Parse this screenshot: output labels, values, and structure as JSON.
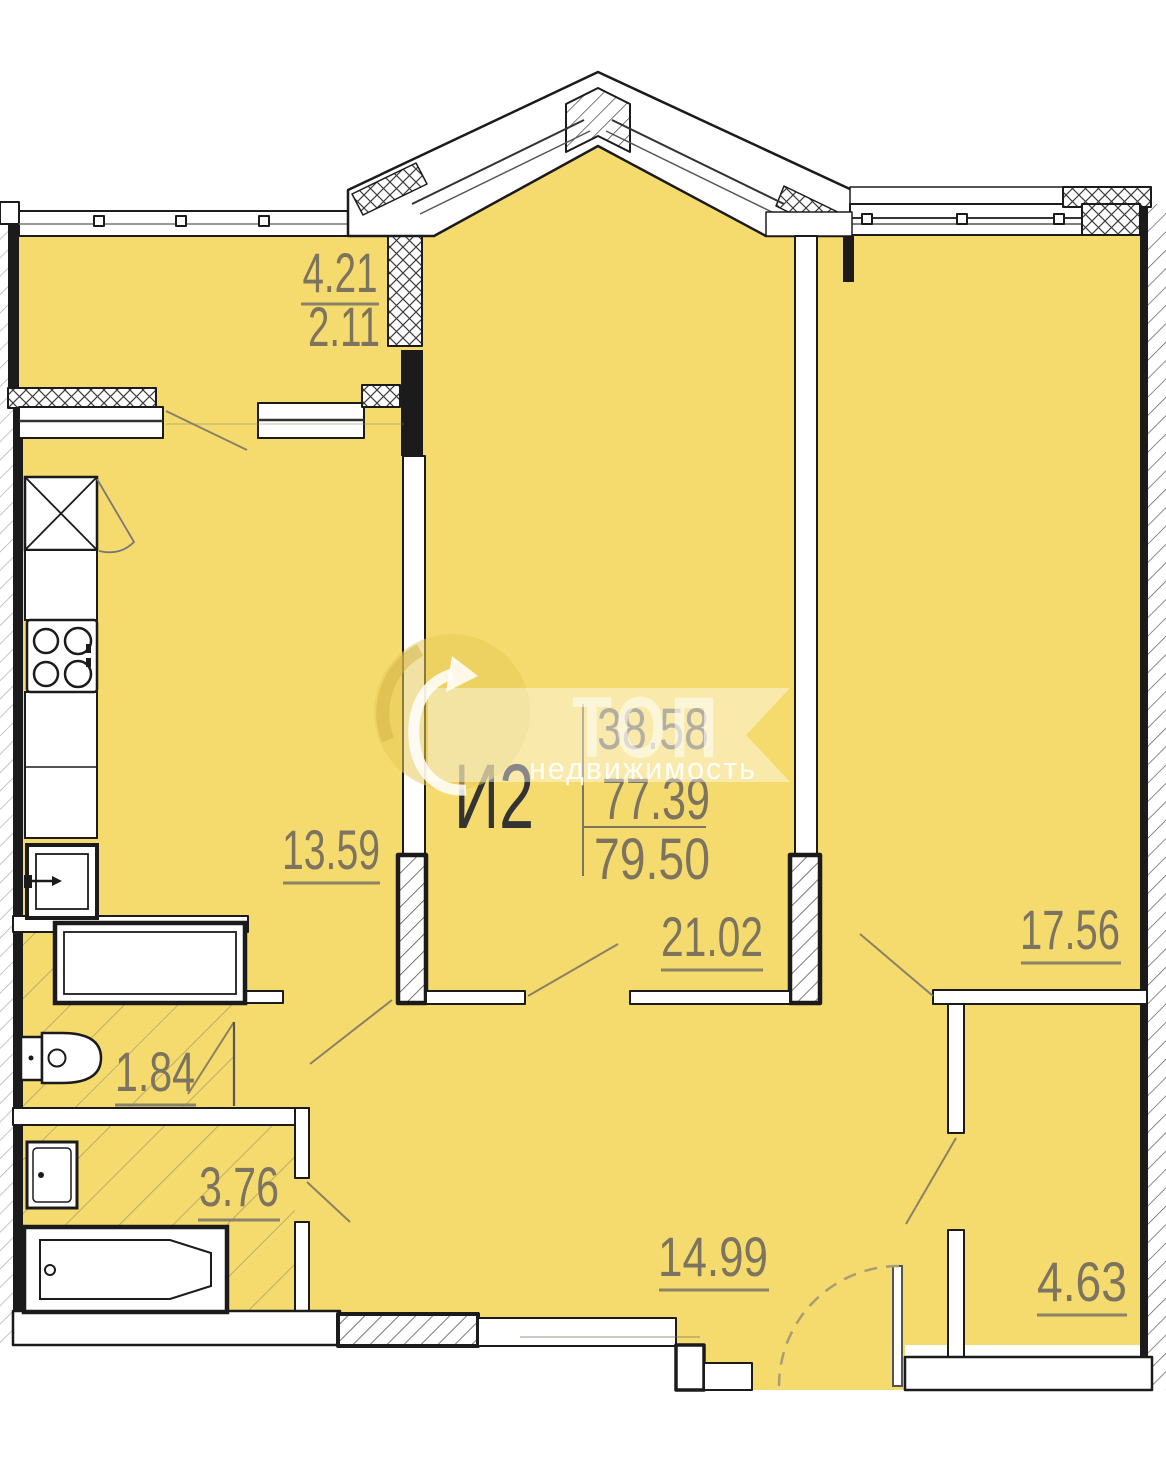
{
  "unit": {
    "label": "И2",
    "area_living": "38.58",
    "area_mid": "77.39",
    "area_total": "79.50"
  },
  "rooms": {
    "balcony_area_full": "4.21",
    "balcony_area_reduced": "2.11",
    "kitchen": "13.59",
    "living": "21.02",
    "bedroom": "17.56",
    "wc": "1.84",
    "bathroom": "3.76",
    "hallway": "14.99",
    "wardrobe": "4.63"
  },
  "watermark": {
    "brand": "ТОП",
    "brand_sub": "недвижимость"
  },
  "colors": {
    "room_fill": "#F5DB6E",
    "wall": "#1B1B1B",
    "dimension_text": "#7C745F",
    "unit_text": "#333333"
  }
}
